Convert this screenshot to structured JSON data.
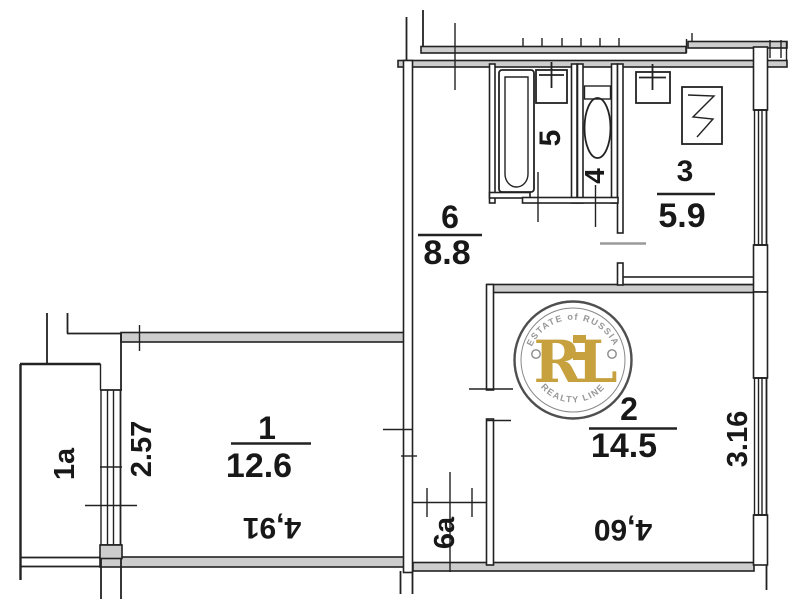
{
  "plan": {
    "rooms": {
      "balcony": {
        "label": "1a"
      },
      "room1": {
        "label": "1",
        "area": "12.6",
        "dim_bottom": "4,91",
        "dim_side": "2.57"
      },
      "room2": {
        "label": "2",
        "area": "14.5",
        "dim_bottom": "4,60",
        "dim_side": "3.16"
      },
      "kitchen": {
        "label": "3",
        "area": "5.9"
      },
      "wc": {
        "label": "4"
      },
      "bathroom": {
        "label": "5"
      },
      "hall": {
        "label": "6",
        "area": "8.8"
      },
      "corridor": {
        "label": "6a"
      }
    },
    "watermark": {
      "initials": "RL",
      "arc_top": "ESTATE of RUSSIA",
      "arc_bottom": "REALTY LINE"
    },
    "colors": {
      "line": "#222222",
      "wall_fill": "#cdcdcd",
      "watermark_gold": "#c6a13d",
      "watermark_gray": "#979797"
    }
  }
}
